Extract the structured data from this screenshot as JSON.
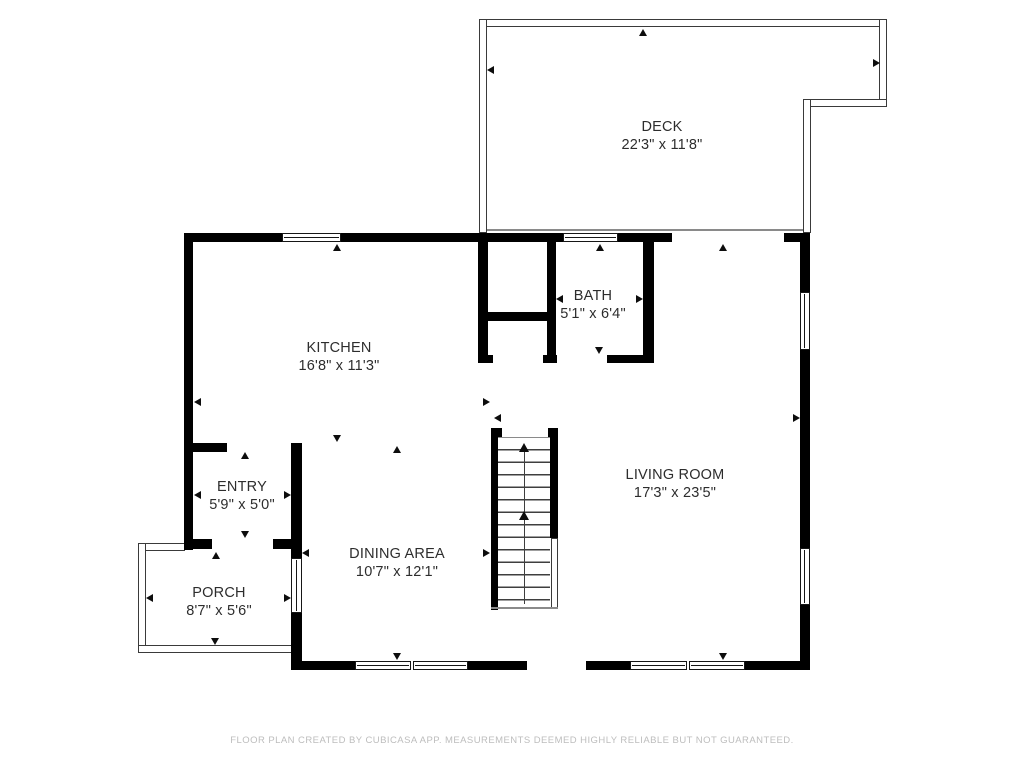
{
  "plan": {
    "source_note": "FLOOR PLAN CREATED BY CUBICASA APP. MEASUREMENTS DEEMED HIGHLY RELIABLE BUT NOT GUARANTEED."
  },
  "rooms": [
    {
      "id": "deck",
      "name": "DECK",
      "dims": "22'3\" x 11'8\""
    },
    {
      "id": "kitchen",
      "name": "KITCHEN",
      "dims": "16'8\" x 11'3\""
    },
    {
      "id": "bath",
      "name": "BATH",
      "dims": "5'1\" x 6'4\""
    },
    {
      "id": "living-room",
      "name": "LIVING ROOM",
      "dims": "17'3\" x 23'5\""
    },
    {
      "id": "dining-area",
      "name": "DINING AREA",
      "dims": "10'7\" x 12'1\""
    },
    {
      "id": "entry",
      "name": "ENTRY",
      "dims": "5'9\" x 5'0\""
    },
    {
      "id": "porch",
      "name": "PORCH",
      "dims": "8'7\" x 5'6\""
    }
  ],
  "colors": {
    "wall": "#000000",
    "railing_outline": "#3a3a3a",
    "label_text": "#2d2d2d",
    "footer_text": "#bdbdbd",
    "background": "#ffffff"
  },
  "icons": {
    "measure_arrow": "small solid triangle marking measured room extents",
    "stairs_direction": "up arrow along stair centerline"
  }
}
